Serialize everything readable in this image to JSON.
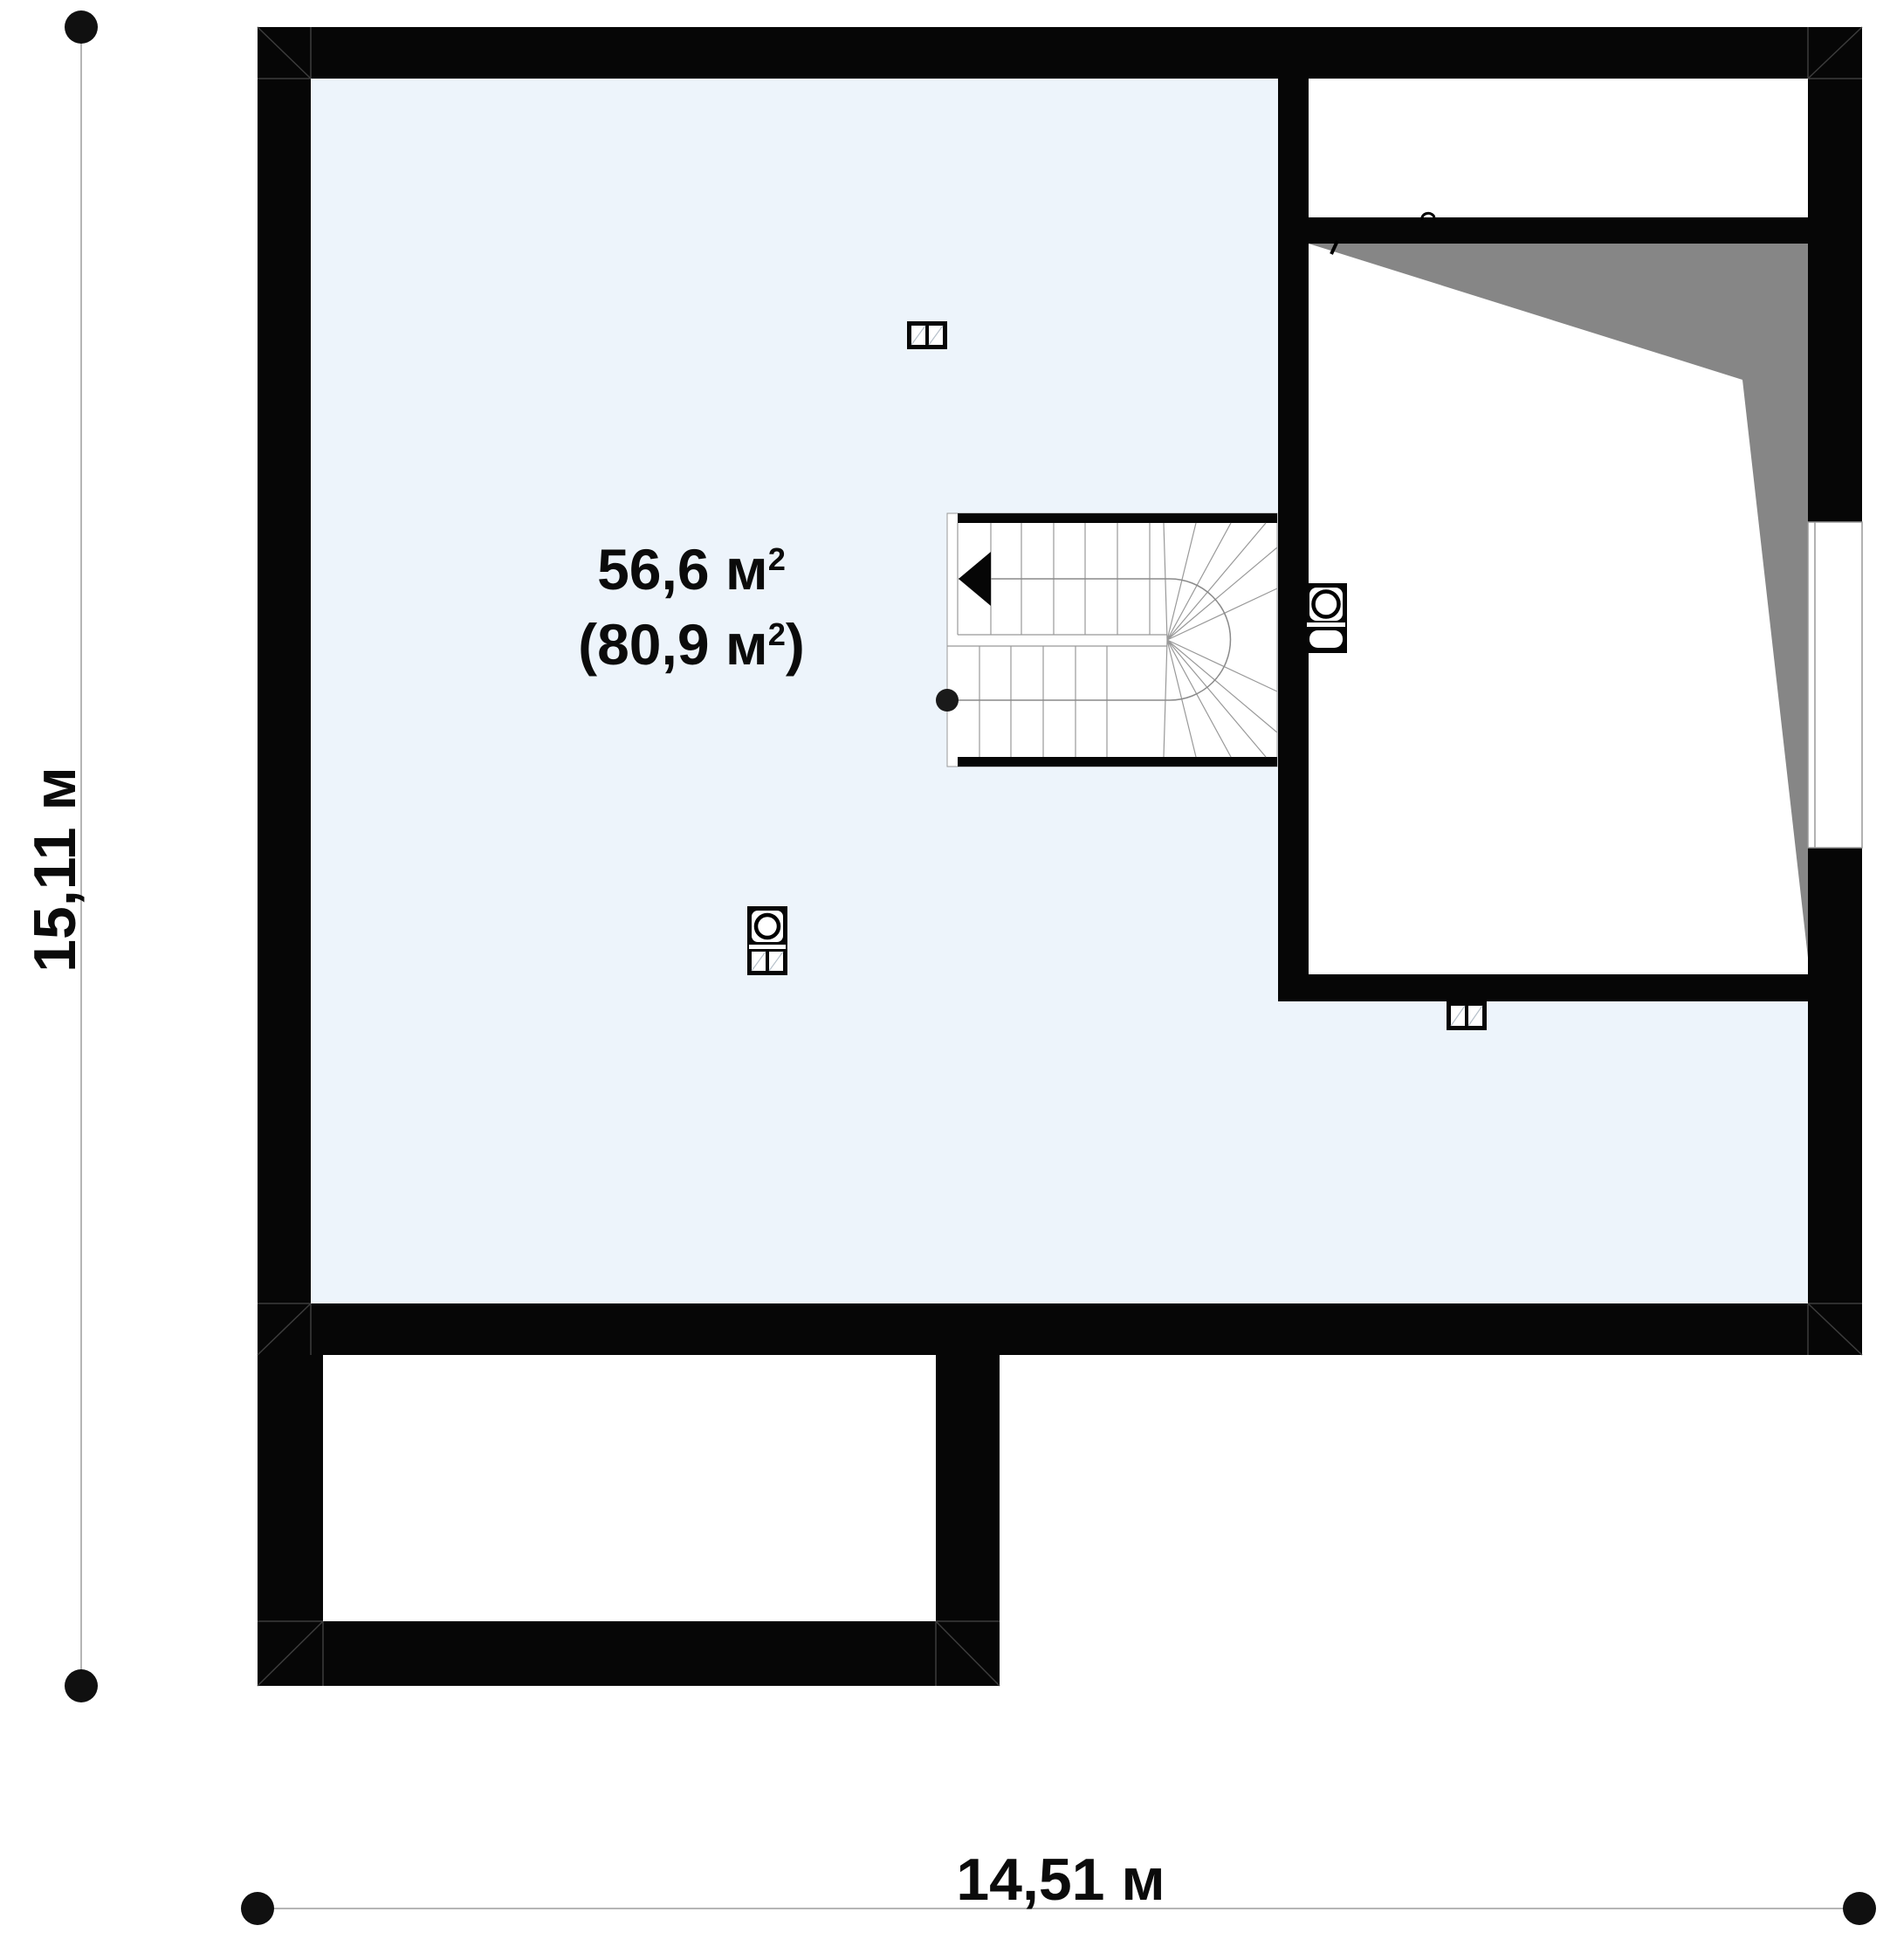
{
  "title": "attic floor plan",
  "texts": {
    "area_main": "56,6 м",
    "area_main_sup": "2",
    "area_alt_open": "(80,9 м",
    "area_alt_sup": "2",
    "area_alt_close": ")",
    "height_dim": "15,11 м",
    "width_dim": "14,51 м"
  },
  "measurements": {
    "plan_width_m": "14,51",
    "plan_height_m": "15,11",
    "area_usable_m2": "56,6",
    "area_gross_m2": "80,9"
  },
  "colors": {
    "ink": "#0b0b0b",
    "wall": "#060606",
    "room_fill": "#edf4fb",
    "roof_shade": "#868686",
    "dim_line": "#b5b5b5",
    "detail_line": "#999999",
    "pane_line": "#b6c0ca",
    "joint_line": "#3c3c3c"
  },
  "icons": {
    "survey_point": "filled-circle",
    "stair_direction": "left-arrow-triangle",
    "stair_start": "filled-circle",
    "chimney": "circle-in-square-with-grille",
    "roof_window": "double-pane-window"
  }
}
